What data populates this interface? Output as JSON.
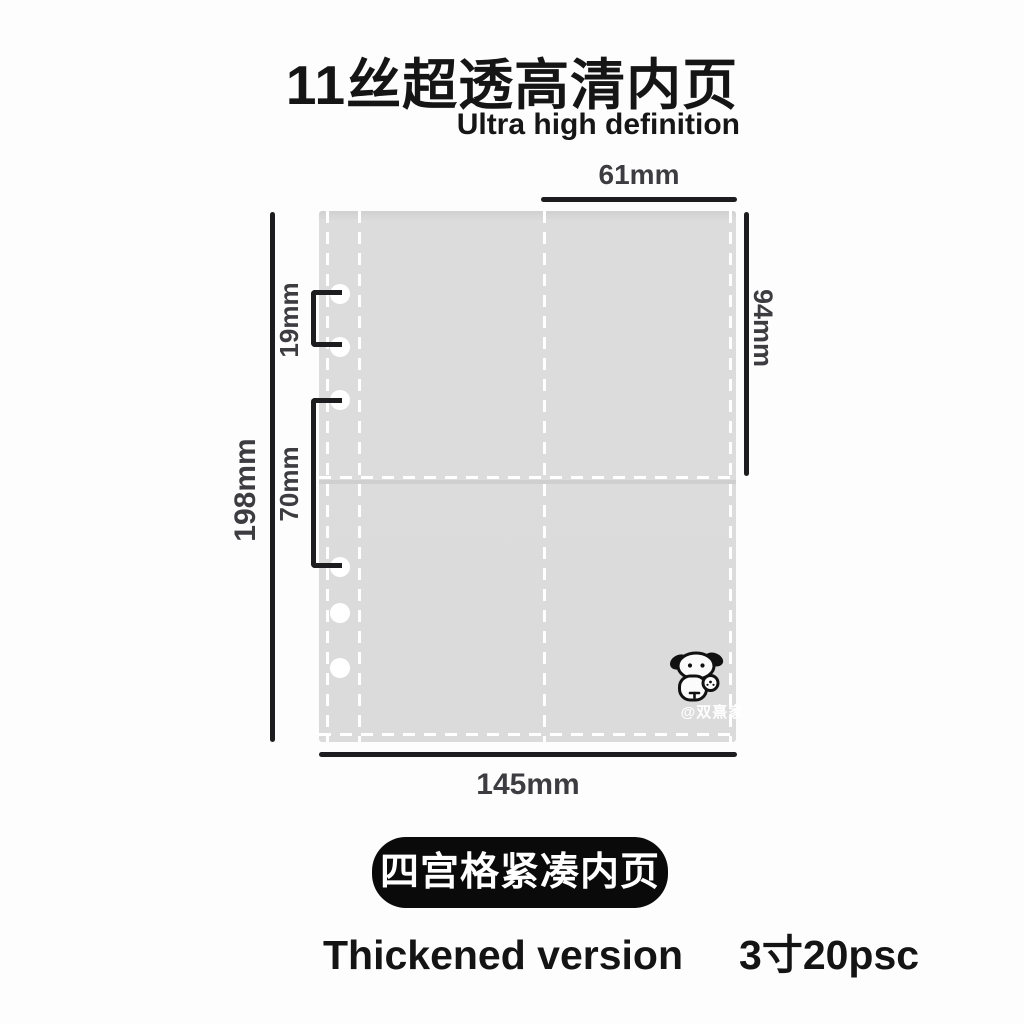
{
  "header": {
    "title": "11丝超透高清内页",
    "subtitle": "Ultra high definition"
  },
  "diagram": {
    "measurements": {
      "pocket_width": "61mm",
      "pocket_height": "94mm",
      "hole_pitch": "19mm",
      "hole_group_gap": "70mm",
      "sheet_height": "198mm",
      "sheet_width": "145mm"
    },
    "sheet": {
      "grid": "2x2 pockets",
      "holes_count": 6
    },
    "watermark": "@双熹家"
  },
  "footer": {
    "badge": "四宫格紧凑内页",
    "left_text": "Thickened version",
    "right_text": "3寸20psc"
  },
  "colors": {
    "background": "#fdfdfd",
    "sheet_fill": "#dcdcdd",
    "seam_dash": "#ffffff",
    "measure_line": "#1d1d1f",
    "label_text": "#3d3d41",
    "title_text": "#151515",
    "badge_bg": "#0a0a0a",
    "badge_text": "#ffffff"
  }
}
